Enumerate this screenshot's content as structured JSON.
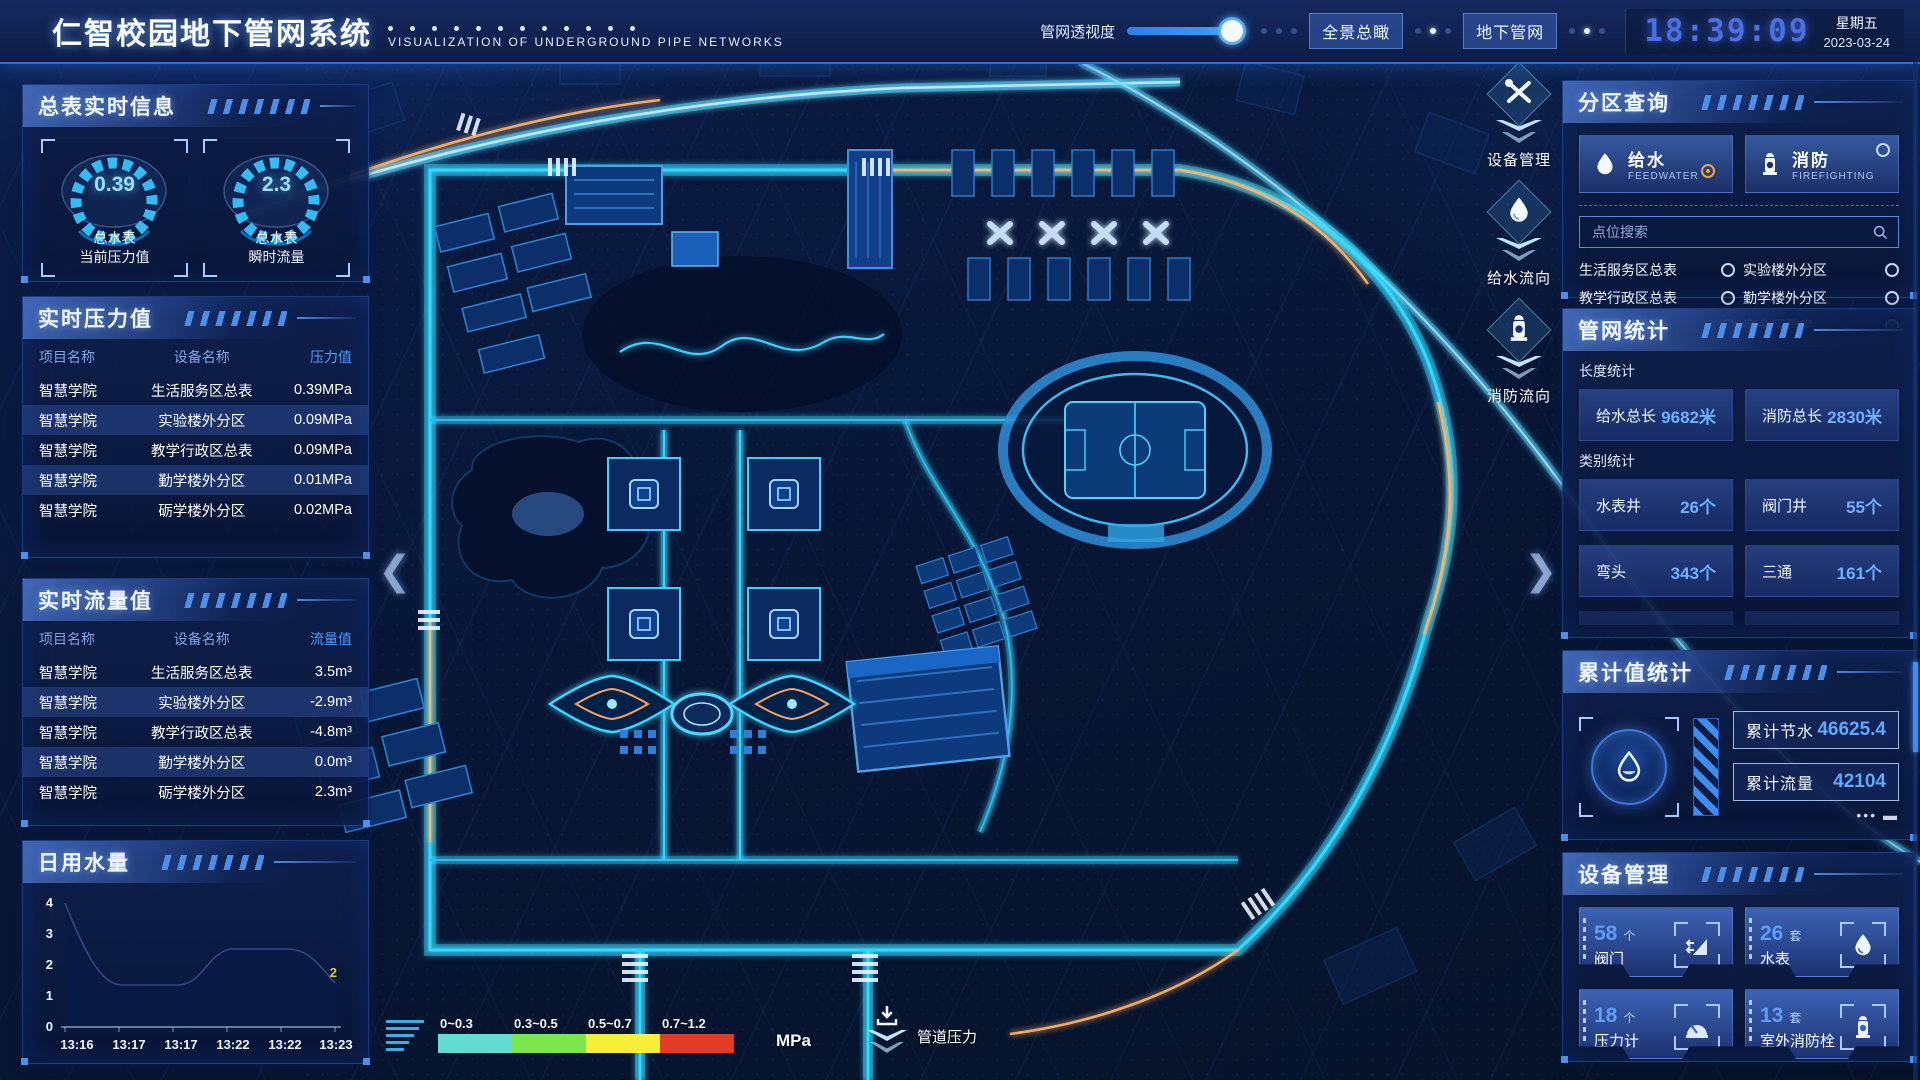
{
  "header": {
    "title": "仁智校园地下管网系统",
    "subtitle": "VISUALIZATION OF UNDERGROUND PIPE NETWORKS",
    "slider_label": "管网透视度",
    "btn_panorama": "全景总瞰",
    "btn_underground": "地下管网",
    "time": "18:39:09",
    "weekday": "星期五",
    "date": "2023-03-24"
  },
  "left": {
    "meter_panel": {
      "title": "总表实时信息",
      "gauges": [
        {
          "value": "0.39",
          "line1": "总水表",
          "line2": "当前压力值"
        },
        {
          "value": "2.3",
          "line1": "总水表",
          "line2": "瞬时流量"
        }
      ]
    },
    "pressure_panel": {
      "title": "实时压力值",
      "headers": [
        "项目名称",
        "设备名称",
        "压力值"
      ],
      "rows": [
        [
          "智慧学院",
          "生活服务区总表",
          "0.39MPa"
        ],
        [
          "智慧学院",
          "实验楼外分区",
          "0.09MPa"
        ],
        [
          "智慧学院",
          "教学行政区总表",
          "0.09MPa"
        ],
        [
          "智慧学院",
          "勤学楼外分区",
          "0.01MPa"
        ],
        [
          "智慧学院",
          "砺学楼外分区",
          "0.02MPa"
        ]
      ]
    },
    "flow_panel": {
      "title": "实时流量值",
      "headers": [
        "项目名称",
        "设备名称",
        "流量值"
      ],
      "rows": [
        [
          "智慧学院",
          "生活服务区总表",
          "3.5m³"
        ],
        [
          "智慧学院",
          "实验楼外分区",
          "-2.9m³"
        ],
        [
          "智慧学院",
          "教学行政区总表",
          "-4.8m³"
        ],
        [
          "智慧学院",
          "勤学楼外分区",
          "0.0m³"
        ],
        [
          "智慧学院",
          "砺学楼外分区",
          "2.3m³"
        ]
      ]
    },
    "daily_panel": {
      "title": "日用水量"
    }
  },
  "chart_data": {
    "type": "area",
    "title": "日用水量",
    "x": [
      "13:16",
      "13:17",
      "13:17",
      "13:22",
      "13:22",
      "13:23"
    ],
    "values": [
      4,
      2,
      2,
      3,
      3,
      2
    ],
    "y_ticks": [
      "4",
      "3",
      "2",
      "1",
      "0"
    ],
    "ylim": [
      0,
      4
    ],
    "end_label": "2",
    "grid": false,
    "legend": "none"
  },
  "right": {
    "zone_panel": {
      "title": "分区查询",
      "feedwater": {
        "label": "给水",
        "sub": "FEEDWATER",
        "selected": true
      },
      "firefighting": {
        "label": "消防",
        "sub": "FIREFIGHTING",
        "selected": false
      },
      "search_placeholder": "点位搜索",
      "items": [
        "生活服务区总表",
        "实验楼外分区",
        "教学行政区总表",
        "勤学楼外分区",
        "砺学楼外分区",
        "宿舍区泵房"
      ]
    },
    "network_panel": {
      "title": "管网统计",
      "length_label": "长度统计",
      "length_stats": [
        {
          "label": "给水总长",
          "value": "9682米"
        },
        {
          "label": "消防总长",
          "value": "2830米"
        }
      ],
      "category_label": "类别统计",
      "category_stats": [
        {
          "label": "水表井",
          "value": "26个"
        },
        {
          "label": "阀门井",
          "value": "55个"
        },
        {
          "label": "弯头",
          "value": "343个"
        },
        {
          "label": "三通",
          "value": "161个"
        }
      ]
    },
    "cumulative_panel": {
      "title": "累计值统计",
      "stats": [
        {
          "label": "累计节水",
          "value": "46625.4"
        },
        {
          "label": "累计流量",
          "value": "42104"
        }
      ]
    },
    "device_panel": {
      "title": "设备管理",
      "cards": [
        {
          "count": "58",
          "unit": "个",
          "label": "阀门"
        },
        {
          "count": "26",
          "unit": "套",
          "label": "水表"
        },
        {
          "count": "18",
          "unit": "个",
          "label": "压力计"
        },
        {
          "count": "13",
          "unit": "套",
          "label": "室外消防栓"
        }
      ]
    }
  },
  "map": {
    "float_buttons": [
      {
        "label": "设备管理"
      },
      {
        "label": "给水流向"
      },
      {
        "label": "消防流向"
      }
    ],
    "legend": {
      "ranges": [
        "0~0.3",
        "0.3~0.5",
        "0.5~0.7",
        "0.7~1.2"
      ],
      "colors": [
        "#63dcd4",
        "#7ee64d",
        "#f5ef3c",
        "#e23b28"
      ],
      "unit": "MPa",
      "pressure_label": "管道压力"
    },
    "arrow_left": "❮",
    "arrow_right": "❯"
  },
  "colors": {
    "accent_cyan": "#35d8ff",
    "accent_blue": "#4f8df0",
    "selected_radio": "#f0a63a",
    "panel_bg": "#0d2153",
    "time_blue": "#4a6fe0",
    "road_orange": "#ffb36b"
  }
}
